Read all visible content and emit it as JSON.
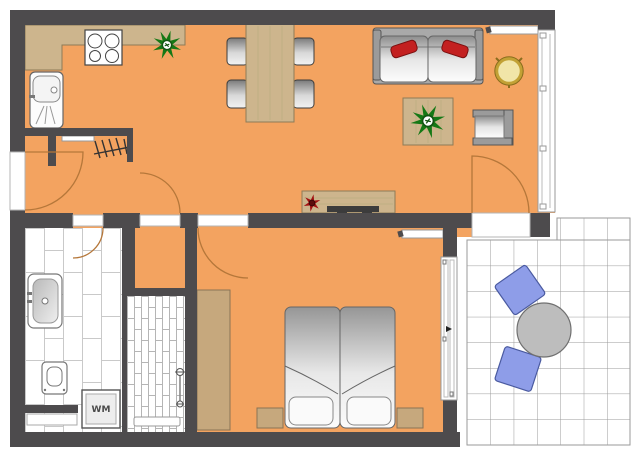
{
  "title": "Apartment floor plan",
  "labels": {
    "washing_machine": "WM"
  },
  "colors": {
    "wall": "#4D4B4D",
    "floor": "#F3A360",
    "wood": "#CDB58D",
    "wood_edge": "#8D7B57",
    "wardrobe": "#C6A87D",
    "tile_line": "#C9C9C9",
    "terrace_line": "#9A9A9A",
    "chair_blue": "#8E9DE8",
    "pillow_red": "#C32020",
    "plant_green": "#157815",
    "door_arc": "#B5773A",
    "gold": "#C2A135",
    "metal": "#9B9B9B"
  },
  "furniture": [
    "kitchen-counter",
    "stove",
    "kitchen-sink",
    "potted-plant",
    "dining-table",
    "dining-chair",
    "sofa",
    "throw-pillow",
    "wall-shelf",
    "gold-side-table",
    "coffee-table",
    "armchair",
    "sideboard",
    "tv",
    "red-flower",
    "coat-rack",
    "double-bed",
    "nightstand",
    "wardrobe",
    "sliding-door",
    "window",
    "washbasin",
    "toilet",
    "washing-machine",
    "shower",
    "shower-valves",
    "terrace-round-table",
    "terrace-chair"
  ]
}
